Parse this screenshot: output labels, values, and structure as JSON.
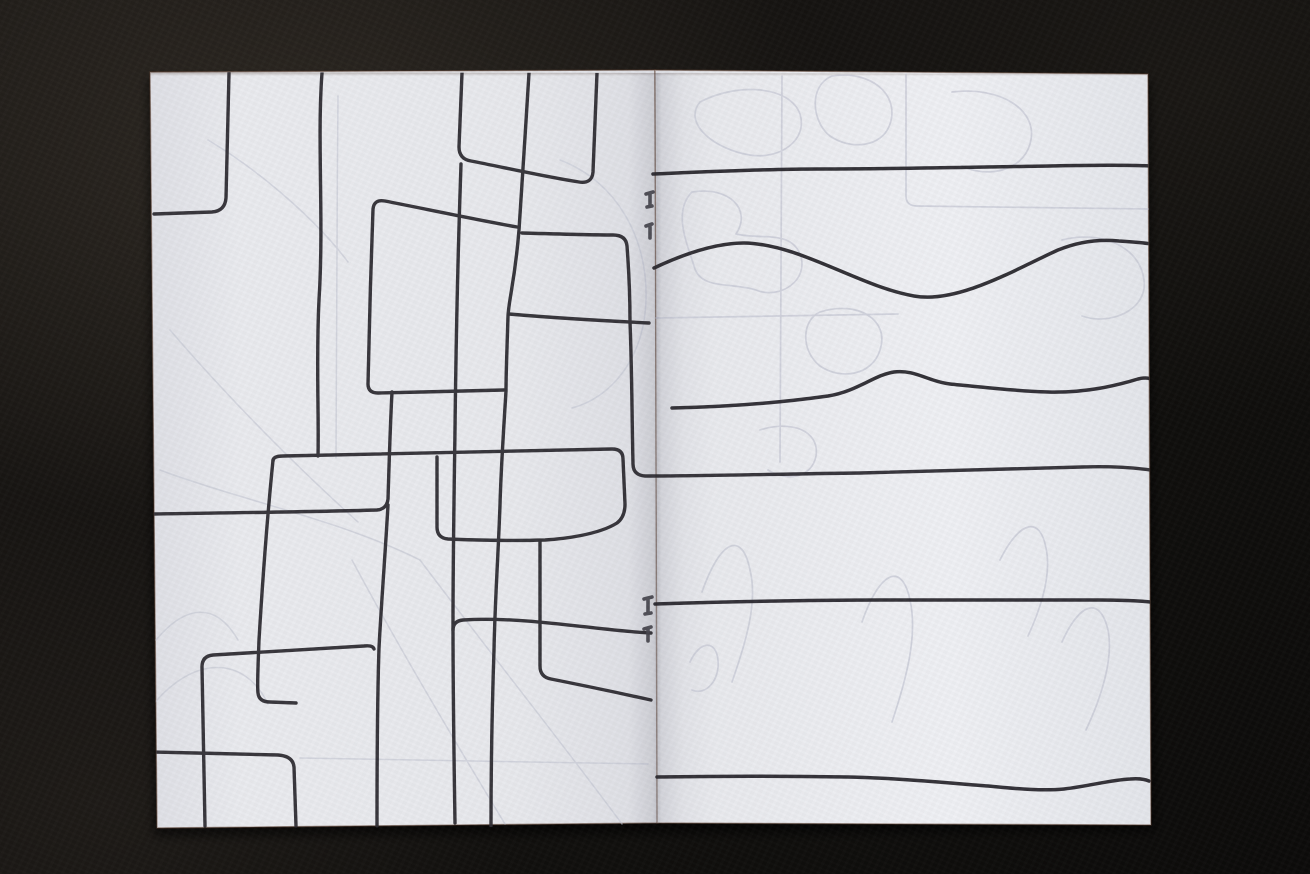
{
  "meta": {
    "description": "Photograph of an open saddle-stitched zine lying on dark black leather. The left page is covered with an abstract doodle of overlapping rounded rectangles and pipe-like lines in black ink; the right page has six roughly horizontal black lines, two of them wavy. Four staples sit along the centre fold, and faint pencil shapes show through the thin paper."
  },
  "palette": {
    "background": "#12100e",
    "background_sheen": "#2b2723",
    "page_left_fill": "#e9eaee",
    "page_right_fill": "#edeef2",
    "page_edge": "rgba(92,62,46,0.5)",
    "ink": "#2d2b31",
    "ink_right": "#2a282e",
    "show_through": "#c7c9d6",
    "show_through_left": "#c3c6d3",
    "staple": "#45444c",
    "shadow": "rgba(0,0,0,0.6)"
  },
  "booklet": {
    "shadow_points": "148,78 1150,80 1156,832 154,836",
    "left_page_points": "150,72 655,70 658,823 157,828",
    "right_page_points": "655,70 1148,74 1151,825 657,823",
    "spine_band": {
      "x": 628,
      "y": 70,
      "w": 56,
      "h": 754
    },
    "staples": [
      "M 646 194 L 653 192 M 650 193 L 650 206 M 647 207 L 652 206",
      "M 646 226 L 652 224 M 650 226 L 650 238",
      "M 644 599 L 652 597 M 648 598 L 648 613 M 645 614 L 651 613",
      "M 644 629 L 651 627 M 648 628 L 648 641"
    ]
  },
  "artwork": {
    "left_ink": [
      "M 229 73 C 228 120 227 165 226 198 Q 225 211 212 212 L 154 214",
      "M 322 73 C 317 140 324 220 319 300 C 316 360 319 415 318 456",
      "M 462 73 L 459 147 Q 459 159 471 161 C 502 167 546 177 579 182 Q 592 184 593 172 L 597 73",
      "M 529 73 C 526 125 522 180 519 230 C 515 280 509 298 508 316 C 507 350 506 372 506 391 C 503 440 501 468 500 505 C 498 560 495 600 494 650 C 492 710 491 780 491 826",
      "M 517 227 C 472 219 421 208 385 201 Q 374 199 373 209 C 371 265 369 330 368 384 Q 368 393 378 393 C 420 392 468 391 504 390",
      "M 522 233 C 556 234 590 235 613 235 Q 626 235 627 246 C 629 272 630 300 630 322 C 632 372 632 425 633 464 Q 633 475 645 476 C 700 476 780 474 860 473 C 940 471 1020 469 1082 467 C 1112 466 1136 468 1150 470",
      "M 509 314 C 555 318 608 321 649 323",
      "M 273 461 Q 273 456 283 456 C 390 453 500 451 612 449 Q 623 449 623 459 L 625 504 Q 625 517 617 523 C 598 535 562 539 545 540 C 510 541 468 540 448 539 Q 437 538 437 527 L 437 457",
      "M 273 460 C 267 520 262 590 259 640 C 258 668 257 686 258 693 Q 259 702 270 702 L 296 703",
      "M 392 392 C 390 430 389 468 388 499 Q 387 509 377 510 C 310 512 215 513 154 514",
      "M 388 505 C 385 558 381 608 379 648 C 377 708 377 772 377 826",
      "M 205 826 C 204 770 203 718 202 667 Q 202 656 213 655 C 256 652 320 649 364 646 Q 373 645 374 649",
      "M 154 752 C 192 753 242 754 278 755 Q 293 756 294 767 L 296 826",
      "M 651 633 C 600 631 528 616 463 620 Q 453 621 453 630",
      "M 461 164 C 458 250 456 340 455 430 C 454 500 453 560 453 624 C 453 694 454 760 455 823",
      "M 540 541 L 540 666 Q 540 677 551 679 C 586 686 624 694 651 700"
    ],
    "right_ink": [
      "M 653 174 C 700 172 760 169 820 169 C 900 169 980 167 1050 166 C 1092 165 1128 165 1152 166",
      "M 654 268 C 688 252 718 243 744 243 C 800 244 858 286 914 296 C 958 304 1018 268 1058 250 C 1080 241 1100 239 1119 241 C 1134 242 1145 243 1152 244",
      "M 672 408 C 720 407 778 403 828 396 C 858 391 874 375 894 372 C 914 369 930 382 950 384 C 990 388 1018 391 1048 392 C 1088 393 1118 385 1138 379 Q 1146 377 1151 379",
      "M 655 604 C 720 602 800 600 880 600 C 960 600 1040 600 1098 600 C 1120 600 1140 601 1151 602",
      "M 657 777 C 718 776 788 776 848 777 C 898 778 948 783 988 786 C 1018 789 1044 791 1064 789 C 1090 786 1110 780 1130 779 Q 1142 778 1149 781"
    ],
    "show_through_left": [
      "M 170 330 C 230 400 300 470 358 522",
      "M 420 560 C 480 640 560 740 622 824",
      "M 352 560 C 400 650 460 750 505 824",
      "M 156 640 C 186 604 216 602 238 640",
      "M 152 706 C 192 656 244 654 268 704",
      "M 208 140 C 262 172 318 222 348 262",
      "M 338 96 C 337 220 336 350 336 458",
      "M 560 160 C 618 182 648 240 646 300 C 644 360 610 398 572 408",
      "M 300 758 L 648 764",
      "M 160 470 C 240 500 340 520 420 560"
    ],
    "show_through_right": [
      "M 782 76 L 780 462",
      "M 656 318 L 898 314",
      "M 906 74 L 906 196 Q 906 206 917 206 L 1150 209",
      "M 700 102 C 738 82 790 86 800 114 C 808 140 780 160 750 155 C 716 150 682 124 700 102",
      "M 832 76 C 870 70 900 94 890 124 C 882 148 850 150 830 136 C 812 122 808 86 832 76",
      "M 692 192 C 730 186 752 210 736 234 C 762 240 790 230 800 254 C 810 280 780 300 756 290 C 730 282 700 290 694 266 C 688 246 672 212 692 192",
      "M 952 92 C 1000 86 1040 110 1030 144 C 1022 172 986 178 962 166",
      "M 1062 240 C 1100 230 1140 246 1144 280 C 1148 310 1110 326 1082 316",
      "M 820 312 C 858 300 890 320 880 350 C 872 376 840 380 820 366 C 800 350 802 320 820 312",
      "M 702 592 C 720 540 742 530 750 570 C 758 602 746 642 732 682",
      "M 862 622 C 880 570 902 562 910 600 C 918 636 906 680 892 722",
      "M 1062 642 C 1080 602 1100 596 1108 630 C 1114 660 1100 700 1086 730",
      "M 690 662 C 700 640 716 640 718 660 C 720 680 706 696 692 690",
      "M 1000 560 C 1020 520 1040 516 1046 548 C 1052 576 1040 610 1028 636",
      "M 760 430 C 790 420 820 430 816 456 C 812 478 786 482 768 470"
    ]
  }
}
